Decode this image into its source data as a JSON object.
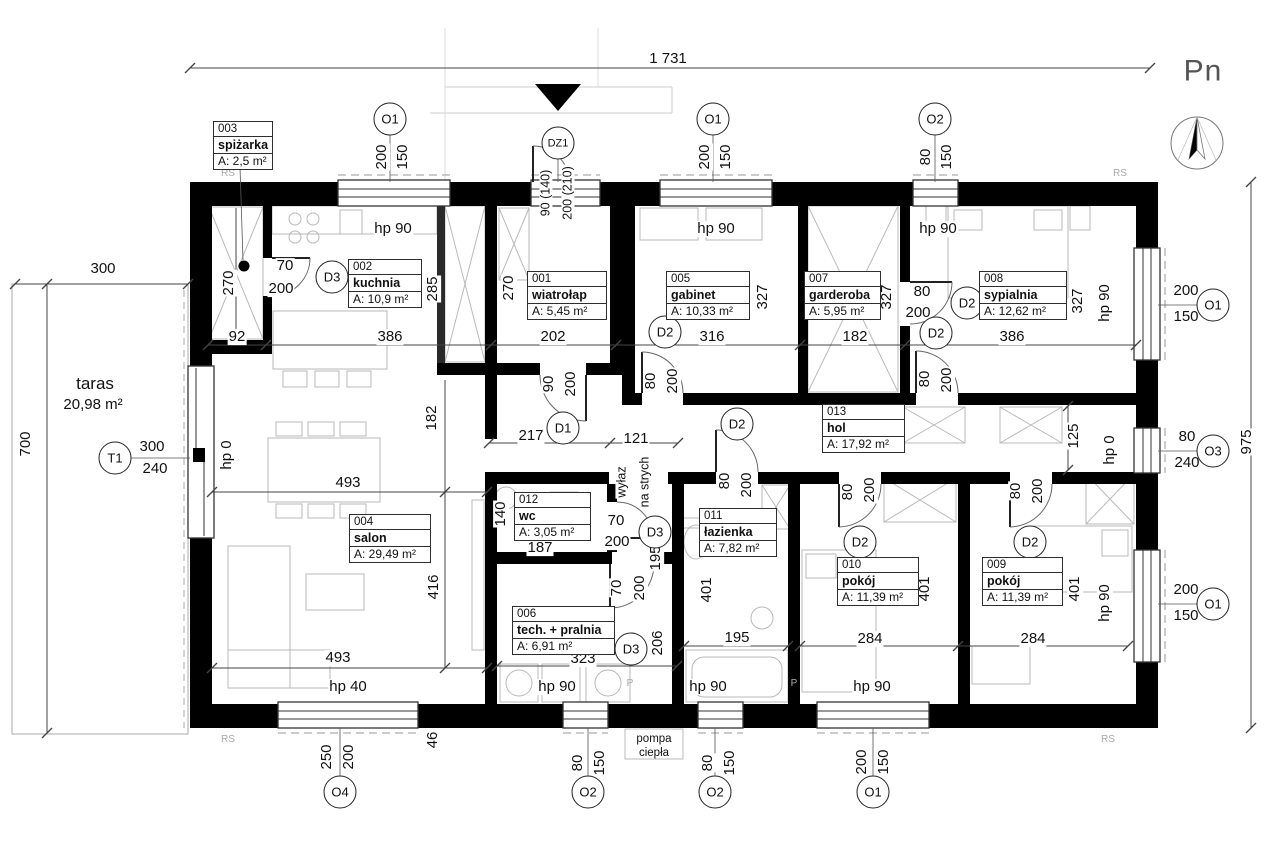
{
  "drawing": {
    "type": "floor-plan",
    "north_label": "Pn",
    "overall_width_label": "1 731",
    "overall_height_label": "975"
  },
  "rooms": [
    {
      "num": "003",
      "name": "spiżarka",
      "area": "A: 2,5 m²",
      "x": 213,
      "y": 121,
      "w": 58
    },
    {
      "num": "002",
      "name": "kuchnia",
      "area": "A: 10,9 m²",
      "x": 348,
      "y": 259,
      "w": 72
    },
    {
      "num": "001",
      "name": "wiatrołap",
      "area": "A: 5,45 m²",
      "x": 527,
      "y": 271,
      "w": 78
    },
    {
      "num": "005",
      "name": "gabinet",
      "area": "A: 10,33 m²",
      "x": 666,
      "y": 271,
      "w": 82
    },
    {
      "num": "007",
      "name": "garderoba",
      "area": "A: 5,95 m²",
      "x": 804,
      "y": 271,
      "w": 75
    },
    {
      "num": "008",
      "name": "sypialnia",
      "area": "A: 12,62 m²",
      "x": 979,
      "y": 271,
      "w": 86
    },
    {
      "num": "013",
      "name": "hol",
      "area": "A: 17,92 m²",
      "x": 822,
      "y": 404,
      "w": 81
    },
    {
      "num": "004",
      "name": "salon",
      "area": "A: 29,49 m²",
      "x": 349,
      "y": 514,
      "w": 80
    },
    {
      "num": "012",
      "name": "wc",
      "area": "A: 3,05 m²",
      "x": 514,
      "y": 492,
      "w": 75
    },
    {
      "num": "011",
      "name": "łazienka",
      "area": "A: 7,82 m²",
      "x": 699,
      "y": 508,
      "w": 76
    },
    {
      "num": "010",
      "name": "pokój",
      "area": "A: 11,39 m²",
      "x": 837,
      "y": 557,
      "w": 80
    },
    {
      "num": "009",
      "name": "pokój",
      "area": "A: 11,39 m²",
      "x": 982,
      "y": 557,
      "w": 79
    },
    {
      "num": "006",
      "name": "tech. + pralnia",
      "area": "A: 6,91 m²",
      "x": 512,
      "y": 606,
      "w": 101
    }
  ],
  "markers": [
    {
      "t": "O1",
      "x": 390,
      "y": 119
    },
    {
      "t": "DZ1",
      "x": 558,
      "y": 143,
      "w3": true
    },
    {
      "t": "O1",
      "x": 713,
      "y": 119
    },
    {
      "t": "O2",
      "x": 935,
      "y": 119
    },
    {
      "t": "O1",
      "x": 1213,
      "y": 305
    },
    {
      "t": "O3",
      "x": 1213,
      "y": 451
    },
    {
      "t": "O1",
      "x": 1213,
      "y": 604
    },
    {
      "t": "T1",
      "x": 115,
      "y": 458
    },
    {
      "t": "D3",
      "x": 332,
      "y": 277
    },
    {
      "t": "D1",
      "x": 563,
      "y": 428
    },
    {
      "t": "D2",
      "x": 665,
      "y": 332
    },
    {
      "t": "D2",
      "x": 967,
      "y": 303
    },
    {
      "t": "D2",
      "x": 936,
      "y": 333
    },
    {
      "t": "D2",
      "x": 737,
      "y": 424
    },
    {
      "t": "D2",
      "x": 860,
      "y": 542
    },
    {
      "t": "D2",
      "x": 1030,
      "y": 542
    },
    {
      "t": "D3",
      "x": 655,
      "y": 532
    },
    {
      "t": "D3",
      "x": 631,
      "y": 649
    },
    {
      "t": "O4",
      "x": 340,
      "y": 792
    },
    {
      "t": "O2",
      "x": 588,
      "y": 792
    },
    {
      "t": "O2",
      "x": 715,
      "y": 792
    },
    {
      "t": "O1",
      "x": 873,
      "y": 792
    }
  ],
  "labels": [
    {
      "t": "1 731",
      "x": 668,
      "y": 59
    },
    {
      "t": "Pn",
      "x": 1203,
      "y": 71,
      "c": "pn"
    },
    {
      "t": "300",
      "x": 103,
      "y": 269
    },
    {
      "t": "taras",
      "x": 95,
      "y": 384,
      "c": "big"
    },
    {
      "t": "20,98 m²",
      "x": 93,
      "y": 405
    },
    {
      "t": "300",
      "x": 152,
      "y": 447
    },
    {
      "t": "240",
      "x": 155,
      "y": 469
    },
    {
      "t": "70",
      "x": 285,
      "y": 266
    },
    {
      "t": "200",
      "x": 281,
      "y": 289
    },
    {
      "t": "92",
      "x": 237,
      "y": 337
    },
    {
      "t": "386",
      "x": 390,
      "y": 337
    },
    {
      "t": "202",
      "x": 553,
      "y": 337
    },
    {
      "t": "316",
      "x": 712,
      "y": 337
    },
    {
      "t": "182",
      "x": 855,
      "y": 337
    },
    {
      "t": "386",
      "x": 1012,
      "y": 337
    },
    {
      "t": "hp 90",
      "x": 393,
      "y": 229
    },
    {
      "t": "hp 90",
      "x": 716,
      "y": 229
    },
    {
      "t": "hp 90",
      "x": 938,
      "y": 229
    },
    {
      "t": "217",
      "x": 531,
      "y": 436
    },
    {
      "t": "121",
      "x": 636,
      "y": 439
    },
    {
      "t": "80",
      "x": 922,
      "y": 292
    },
    {
      "t": "200",
      "x": 918,
      "y": 313
    },
    {
      "t": "493",
      "x": 348,
      "y": 483
    },
    {
      "t": "493",
      "x": 338,
      "y": 658
    },
    {
      "t": "hp 40",
      "x": 348,
      "y": 687
    },
    {
      "t": "hp 90",
      "x": 557,
      "y": 687
    },
    {
      "t": "hp 90",
      "x": 708,
      "y": 687
    },
    {
      "t": "hp 90",
      "x": 872,
      "y": 687
    },
    {
      "t": "187",
      "x": 540,
      "y": 548
    },
    {
      "t": "70",
      "x": 616,
      "y": 521
    },
    {
      "t": "200",
      "x": 617,
      "y": 542
    },
    {
      "t": "195",
      "x": 737,
      "y": 638
    },
    {
      "t": "323",
      "x": 583,
      "y": 659
    },
    {
      "t": "284",
      "x": 870,
      "y": 639
    },
    {
      "t": "284",
      "x": 1033,
      "y": 639
    },
    {
      "t": "200",
      "x": 1186,
      "y": 291
    },
    {
      "t": "150",
      "x": 1186,
      "y": 317
    },
    {
      "t": "80",
      "x": 1187,
      "y": 437
    },
    {
      "t": "240",
      "x": 1187,
      "y": 463
    },
    {
      "t": "200",
      "x": 1186,
      "y": 590
    },
    {
      "t": "150",
      "x": 1186,
      "y": 616
    },
    {
      "t": "pompa",
      "x": 654,
      "y": 739,
      "c": "xs"
    },
    {
      "t": "ciepła",
      "x": 654,
      "y": 753,
      "c": "xs"
    },
    {
      "t": "RS",
      "x": 228,
      "y": 174,
      "c": "gray"
    },
    {
      "t": "RS",
      "x": 1120,
      "y": 174,
      "c": "gray"
    },
    {
      "t": "RS",
      "x": 228,
      "y": 740,
      "c": "gray"
    },
    {
      "t": "RS",
      "x": 1108,
      "y": 740,
      "c": "gray"
    },
    {
      "t": "P",
      "x": 630,
      "y": 684,
      "c": "gray"
    },
    {
      "t": "P",
      "x": 794,
      "y": 684,
      "c": "gray"
    },
    {
      "t": "200",
      "x": 382,
      "y": 157,
      "r": 1
    },
    {
      "t": "150",
      "x": 403,
      "y": 157,
      "r": 1
    },
    {
      "t": "90 (140)",
      "x": 546,
      "y": 193,
      "r": 1,
      "c": "sm"
    },
    {
      "t": "200 (210)",
      "x": 568,
      "y": 193,
      "r": 1,
      "c": "sm"
    },
    {
      "t": "200",
      "x": 705,
      "y": 157,
      "r": 1
    },
    {
      "t": "150",
      "x": 726,
      "y": 157,
      "r": 1
    },
    {
      "t": "80",
      "x": 926,
      "y": 157,
      "r": 1
    },
    {
      "t": "150",
      "x": 947,
      "y": 157,
      "r": 1
    },
    {
      "t": "270",
      "x": 229,
      "y": 283,
      "r": 1
    },
    {
      "t": "285",
      "x": 433,
      "y": 289,
      "r": 1
    },
    {
      "t": "270",
      "x": 509,
      "y": 288,
      "r": 1
    },
    {
      "t": "327",
      "x": 763,
      "y": 297,
      "r": 1
    },
    {
      "t": "327",
      "x": 887,
      "y": 297,
      "r": 1
    },
    {
      "t": "327",
      "x": 1078,
      "y": 301,
      "r": 1
    },
    {
      "t": "90",
      "x": 549,
      "y": 384,
      "r": 1
    },
    {
      "t": "200",
      "x": 571,
      "y": 384,
      "r": 1
    },
    {
      "t": "80",
      "x": 651,
      "y": 381,
      "r": 1
    },
    {
      "t": "200",
      "x": 673,
      "y": 381,
      "r": 1
    },
    {
      "t": "80",
      "x": 925,
      "y": 379,
      "r": 1
    },
    {
      "t": "200",
      "x": 947,
      "y": 380,
      "r": 1
    },
    {
      "t": "182",
      "x": 432,
      "y": 418,
      "r": 1
    },
    {
      "t": "hp 0",
      "x": 227,
      "y": 455,
      "r": 1
    },
    {
      "t": "hp 90",
      "x": 1105,
      "y": 303,
      "r": 1
    },
    {
      "t": "hp 0",
      "x": 1110,
      "y": 450,
      "r": 1
    },
    {
      "t": "hp 90",
      "x": 1105,
      "y": 603,
      "r": 1
    },
    {
      "t": "wyłaz",
      "x": 622,
      "y": 482,
      "r": 1,
      "c": "sm"
    },
    {
      "t": "na strych",
      "x": 645,
      "y": 482,
      "r": 1,
      "c": "sm"
    },
    {
      "t": "80",
      "x": 725,
      "y": 481,
      "r": 1
    },
    {
      "t": "200",
      "x": 747,
      "y": 485,
      "r": 1
    },
    {
      "t": "80",
      "x": 848,
      "y": 492,
      "r": 1
    },
    {
      "t": "200",
      "x": 870,
      "y": 490,
      "r": 1
    },
    {
      "t": "80",
      "x": 1016,
      "y": 491,
      "r": 1
    },
    {
      "t": "200",
      "x": 1038,
      "y": 491,
      "r": 1
    },
    {
      "t": "140",
      "x": 501,
      "y": 514,
      "r": 1
    },
    {
      "t": "195",
      "x": 656,
      "y": 558,
      "r": 1
    },
    {
      "t": "206",
      "x": 658,
      "y": 643,
      "r": 1
    },
    {
      "t": "70",
      "x": 617,
      "y": 588,
      "r": 1
    },
    {
      "t": "200",
      "x": 640,
      "y": 588,
      "r": 1
    },
    {
      "t": "401",
      "x": 707,
      "y": 590,
      "r": 1
    },
    {
      "t": "401",
      "x": 925,
      "y": 589,
      "r": 1
    },
    {
      "t": "401",
      "x": 1075,
      "y": 589,
      "r": 1
    },
    {
      "t": "125",
      "x": 1074,
      "y": 436,
      "r": 1
    },
    {
      "t": "416",
      "x": 434,
      "y": 587,
      "r": 1
    },
    {
      "t": "46",
      "x": 433,
      "y": 740,
      "r": 1
    },
    {
      "t": "250",
      "x": 327,
      "y": 757,
      "r": 1
    },
    {
      "t": "200",
      "x": 349,
      "y": 757,
      "r": 1
    },
    {
      "t": "80",
      "x": 578,
      "y": 763,
      "r": 1
    },
    {
      "t": "150",
      "x": 600,
      "y": 763,
      "r": 1
    },
    {
      "t": "80",
      "x": 708,
      "y": 763,
      "r": 1
    },
    {
      "t": "150",
      "x": 730,
      "y": 763,
      "r": 1
    },
    {
      "t": "200",
      "x": 862,
      "y": 762,
      "r": 1
    },
    {
      "t": "150",
      "x": 884,
      "y": 762,
      "r": 1
    },
    {
      "t": "700",
      "x": 26,
      "y": 444,
      "r": 1
    },
    {
      "t": "975",
      "x": 1247,
      "y": 442,
      "r": 1
    }
  ]
}
